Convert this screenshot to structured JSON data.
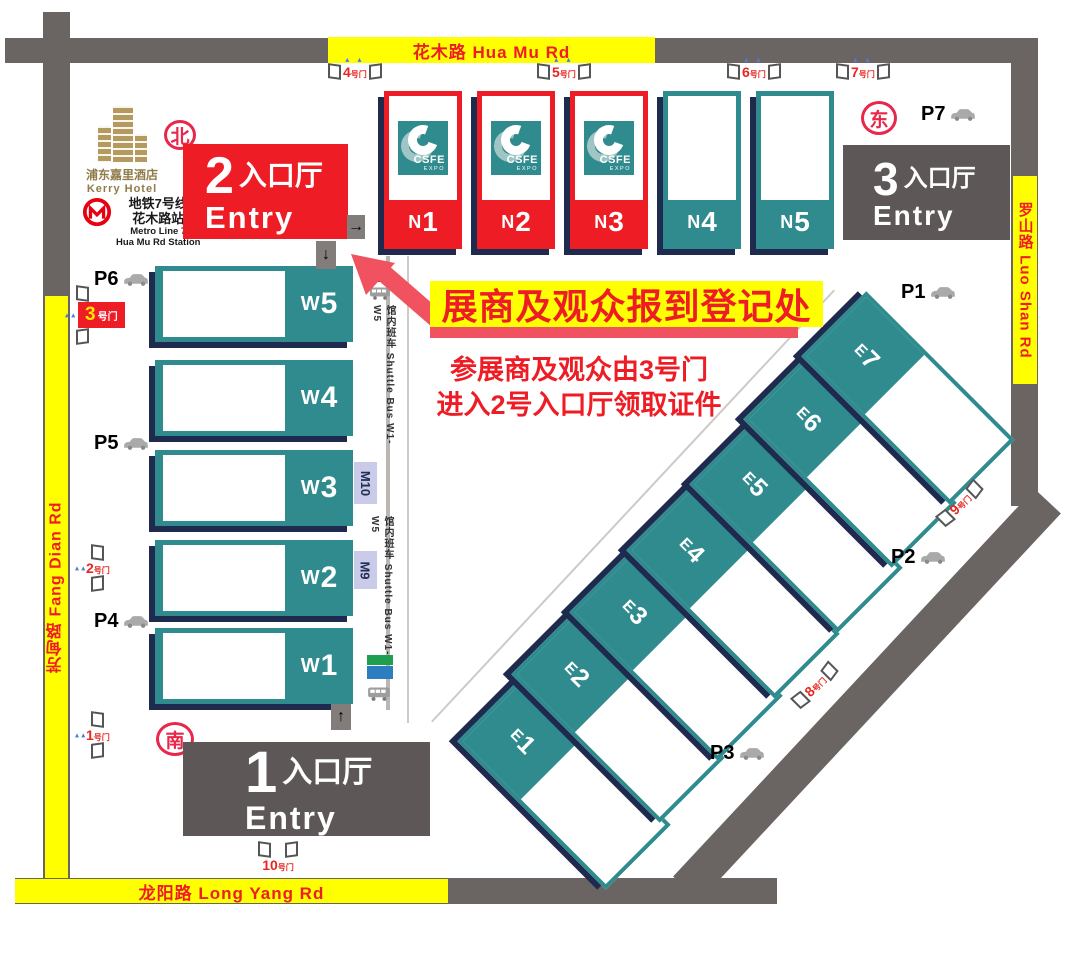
{
  "roads": {
    "top": "花木路 Hua Mu Rd",
    "bottom": "龙阳路 Long Yang Rd",
    "left": "芳甸路 Fang Dian Rd",
    "right": "罗山路 Luo Shan Rd"
  },
  "compass": {
    "north": "北",
    "south": "南",
    "east": "东"
  },
  "landmarks": {
    "hotel_zh": "浦东嘉里酒店",
    "hotel_en": "Kerry Hotel",
    "metro_line_zh": "地铁7号线",
    "metro_station_zh": "花木路站",
    "metro_line_en": "Metro Line 7",
    "metro_station_en": "Hua Mu Rd Station",
    "mcdonalds": "M"
  },
  "entries": {
    "e2": {
      "num": "2",
      "zh": "入口厅",
      "en": "Entry"
    },
    "e3": {
      "num": "3",
      "zh": "入口厅",
      "en": "Entry"
    },
    "e1": {
      "num": "1",
      "zh": "入口厅",
      "en": "Entry"
    }
  },
  "logo": {
    "name": "CSFE",
    "sub": "EXPO"
  },
  "halls": {
    "north": [
      {
        "prefix": "N",
        "num": "1"
      },
      {
        "prefix": "N",
        "num": "2"
      },
      {
        "prefix": "N",
        "num": "3"
      },
      {
        "prefix": "N",
        "num": "4"
      },
      {
        "prefix": "N",
        "num": "5"
      }
    ],
    "west": [
      {
        "prefix": "W",
        "num": "5"
      },
      {
        "prefix": "W",
        "num": "4"
      },
      {
        "prefix": "W",
        "num": "3"
      },
      {
        "prefix": "W",
        "num": "2"
      },
      {
        "prefix": "W",
        "num": "1"
      }
    ],
    "east": [
      {
        "prefix": "E",
        "num": "1"
      },
      {
        "prefix": "E",
        "num": "2"
      },
      {
        "prefix": "E",
        "num": "3"
      },
      {
        "prefix": "E",
        "num": "4"
      },
      {
        "prefix": "E",
        "num": "5"
      },
      {
        "prefix": "E",
        "num": "6"
      },
      {
        "prefix": "E",
        "num": "7"
      }
    ]
  },
  "gates": {
    "top": [
      {
        "num": "4",
        "suffix": "号门"
      },
      {
        "num": "5",
        "suffix": "号门"
      },
      {
        "num": "6",
        "suffix": "号门"
      },
      {
        "num": "7",
        "suffix": "号门"
      }
    ],
    "left": [
      {
        "num": "3",
        "suffix": "号门"
      },
      {
        "num": "2",
        "suffix": "号门"
      },
      {
        "num": "1",
        "suffix": "号门"
      }
    ],
    "right": [
      {
        "num": "9",
        "suffix": "号门"
      },
      {
        "num": "8",
        "suffix": "号门"
      }
    ],
    "bottom": [
      {
        "num": "10",
        "suffix": "号门"
      }
    ]
  },
  "parking": {
    "p1": "P1",
    "p2": "P2",
    "p3": "P3",
    "p4": "P4",
    "p5": "P5",
    "p6": "P6",
    "p7": "P7"
  },
  "metro_exits": [
    "M10",
    "M9"
  ],
  "shuttle": "馆内班车 Shuttle Bus W1-W5",
  "registration": {
    "banner": "展商及观众报到登记处",
    "line1": "参展商及观众由3号门",
    "line2": "进入2号入口厅领取证件"
  },
  "flow_arrows": {
    "right": "→",
    "down": "↓",
    "up": "↑"
  },
  "colors": {
    "red": "#ee1c25",
    "teal": "#2f8b8e",
    "navy": "#1f2b4e",
    "road_gray": "#6a6462",
    "entry_gray": "#5d5857",
    "label_yellow": "#ffff00",
    "arrow_pink": "#f0525f"
  }
}
